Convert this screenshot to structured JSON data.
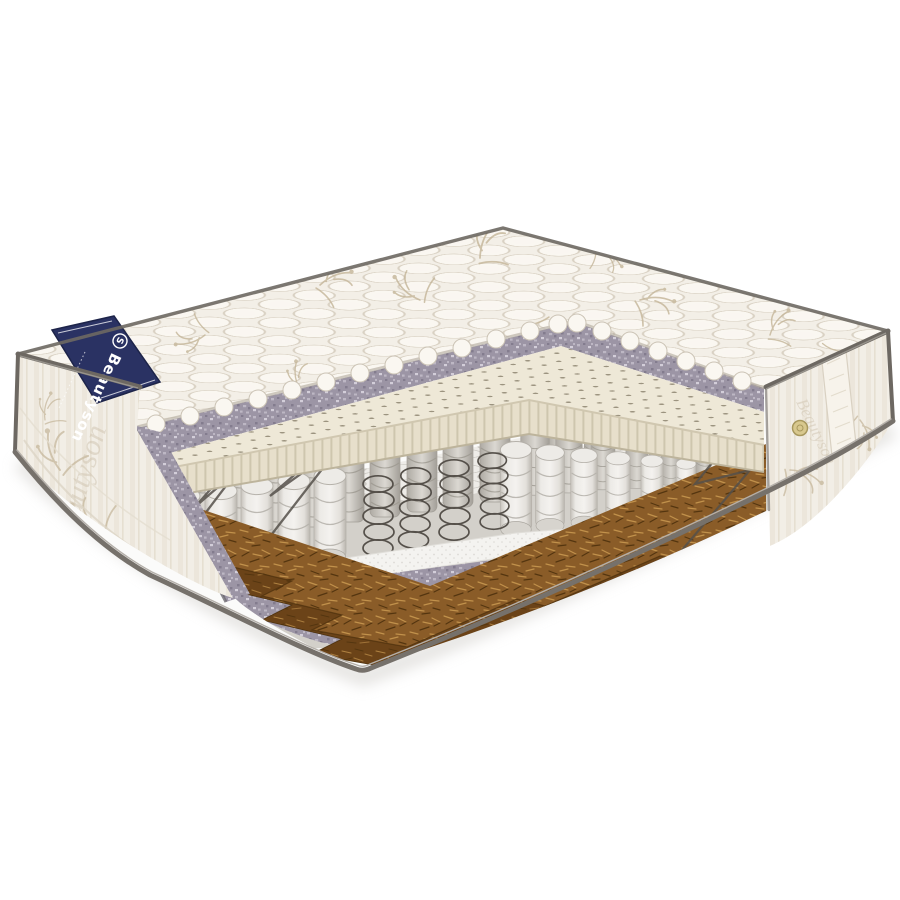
{
  "scene": {
    "description": "Product photo: orthopedic spring mattress with quarter cutaway revealing internal layers",
    "background": "#ffffff"
  },
  "brand": {
    "label": "Beautyson",
    "logo_initial": "S",
    "watermark": "Beautyson"
  },
  "layer_titles": {
    "quilt": "quilted top cover",
    "felt_strip": "felt insulation layer",
    "latex": "perforated natural latex layer",
    "springs": "independent pocket springs",
    "bare_springs": "exposed steel coil springs",
    "spunbond": "spunbond separator sheet",
    "coir": "coconut coir layer",
    "felt_bottom": "bottom felt pad",
    "cover": "bottom quilted cover",
    "left_panel": "side panel (jacquard fabric)",
    "right_panel": "side panel (jacquard fabric)",
    "vent": "air vent eyelet",
    "label": "brand corner label"
  },
  "colors": {
    "bg": "#ffffff",
    "quilt_base": "#f3efe7",
    "quilt_puff": "#faf7f1",
    "quilt_line": "#d9d1c3",
    "floral": "#c3b498",
    "piping": "#6d6862",
    "binding": "#76716b",
    "binding_hi": "#b4afa9",
    "panel_base": "#f2eee6",
    "panel_stripe": "#e6dfd1",
    "panel_motif": "#cdc2ae",
    "label_navy": "#2a3263",
    "label_dark": "#1d2449",
    "label_text": "#ffffff",
    "felt_base": "#9c95a5",
    "felt_light": "#bdb7c4",
    "felt_dark": "#837c8e",
    "felt_pale": "#d3ced9",
    "latex_top": "#eee8d7",
    "latex_face": "#e7dfcb",
    "latex_rib": "#c8bfa6",
    "latex_hole": "#8d8470",
    "latex_edge": "#d0c7b0",
    "spring_bg": "#d3d0ca",
    "spring_line": "#b3afa8",
    "pocket_top": "#eeece8",
    "pocket_ring": "#ccc9c3",
    "wire": "#55504a",
    "spun": "#f4f3f0",
    "spun_dot": "#dcdad5",
    "coir_top": "#8a5c28",
    "coir_face": "#6b4318",
    "coir_light": "#c1914b",
    "coir_dark": "#54350f",
    "cover_white": "#fbfbfa",
    "shadow": "#cfccc8",
    "vent_gold": "#d8c88e",
    "vent_gold_dark": "#a8985e"
  }
}
